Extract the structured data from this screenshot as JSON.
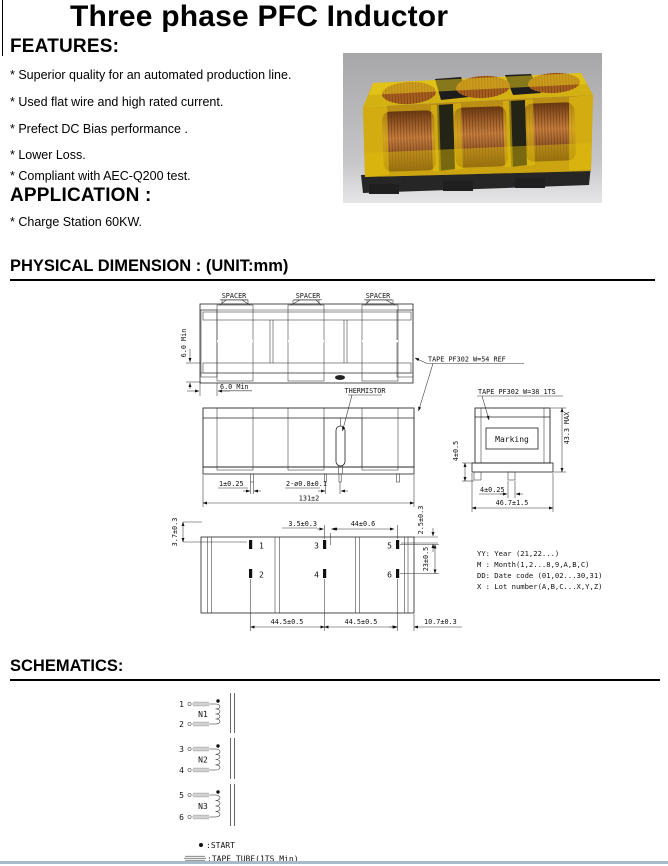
{
  "title": "Three phase PFC Inductor",
  "features": {
    "heading": "FEATURES:",
    "items": [
      "* Superior quality for an automated production line.",
      "* Used flat wire and high rated current.",
      "* Prefect DC Bias performance .",
      "* Lower Loss.",
      "* Compliant with AEC-Q200 test."
    ]
  },
  "application": {
    "heading": "APPLICATION :",
    "item": "* Charge Station 60KW."
  },
  "physical_dimension": {
    "heading": "PHYSICAL DIMENSION : (UNIT:mm)",
    "top_view": {
      "spacer_labels": [
        "SPACER",
        "SPACER",
        "SPACER"
      ],
      "dim_height_min": "6.0 Min",
      "dim_width_min": "6.0 Min",
      "tape_label": "TAPE PF302 W=54 REF"
    },
    "front_view": {
      "thermistor_label": "THERMISTOR",
      "dim_pin_width": "1±0.25",
      "dim_holes": "2-ø0.8±0.1",
      "dim_overall_width": "131±2",
      "dim_left_offset": "3.7±0.3",
      "dim_right_offset": "2.5±0.3"
    },
    "side_view": {
      "tape_label": "TAPE PF302 W=38 1TS",
      "marking_label": "Marking",
      "dim_pin_length": "4±0.5",
      "dim_height_max": "43.3 MAX",
      "dim_pin_width": "4±0.25",
      "dim_depth": "46.7±1.5"
    },
    "bottom_view": {
      "pin_labels": [
        "1",
        "2",
        "3",
        "4",
        "5",
        "6"
      ],
      "dim_pin3_offset": "3.5±0.3",
      "dim_pin_span": "44±0.6",
      "dim_row_pitch": "23±0.5",
      "dim_pitch_a": "44.5±0.5",
      "dim_pitch_b": "44.5±0.5",
      "dim_edge": "10.7±0.3"
    },
    "marking_code": {
      "lines": [
        "YY: Year (21,22...)",
        "M : Month(1,2...8,9,A,B,C)",
        "DD: Date code (01,02...30,31)",
        "X : Lot number(A,B,C...X,Y,Z)"
      ]
    }
  },
  "schematics": {
    "heading": "SCHEMATICS:",
    "windings": [
      {
        "name": "N1",
        "pin_start": "1",
        "pin_end": "2"
      },
      {
        "name": "N2",
        "pin_start": "3",
        "pin_end": "4"
      },
      {
        "name": "N3",
        "pin_start": "5",
        "pin_end": "6"
      }
    ],
    "legend": {
      "start": ":START",
      "tape_tube": ":TAPE TUBE(1TS Min)"
    }
  },
  "colors": {
    "tape_yellow": "#d7b213",
    "copper": "#a65f26",
    "core_dark": "#1d1d1d",
    "photo_background": "#b3b3b5",
    "bottom_rule_blue": "#a9bbca"
  }
}
